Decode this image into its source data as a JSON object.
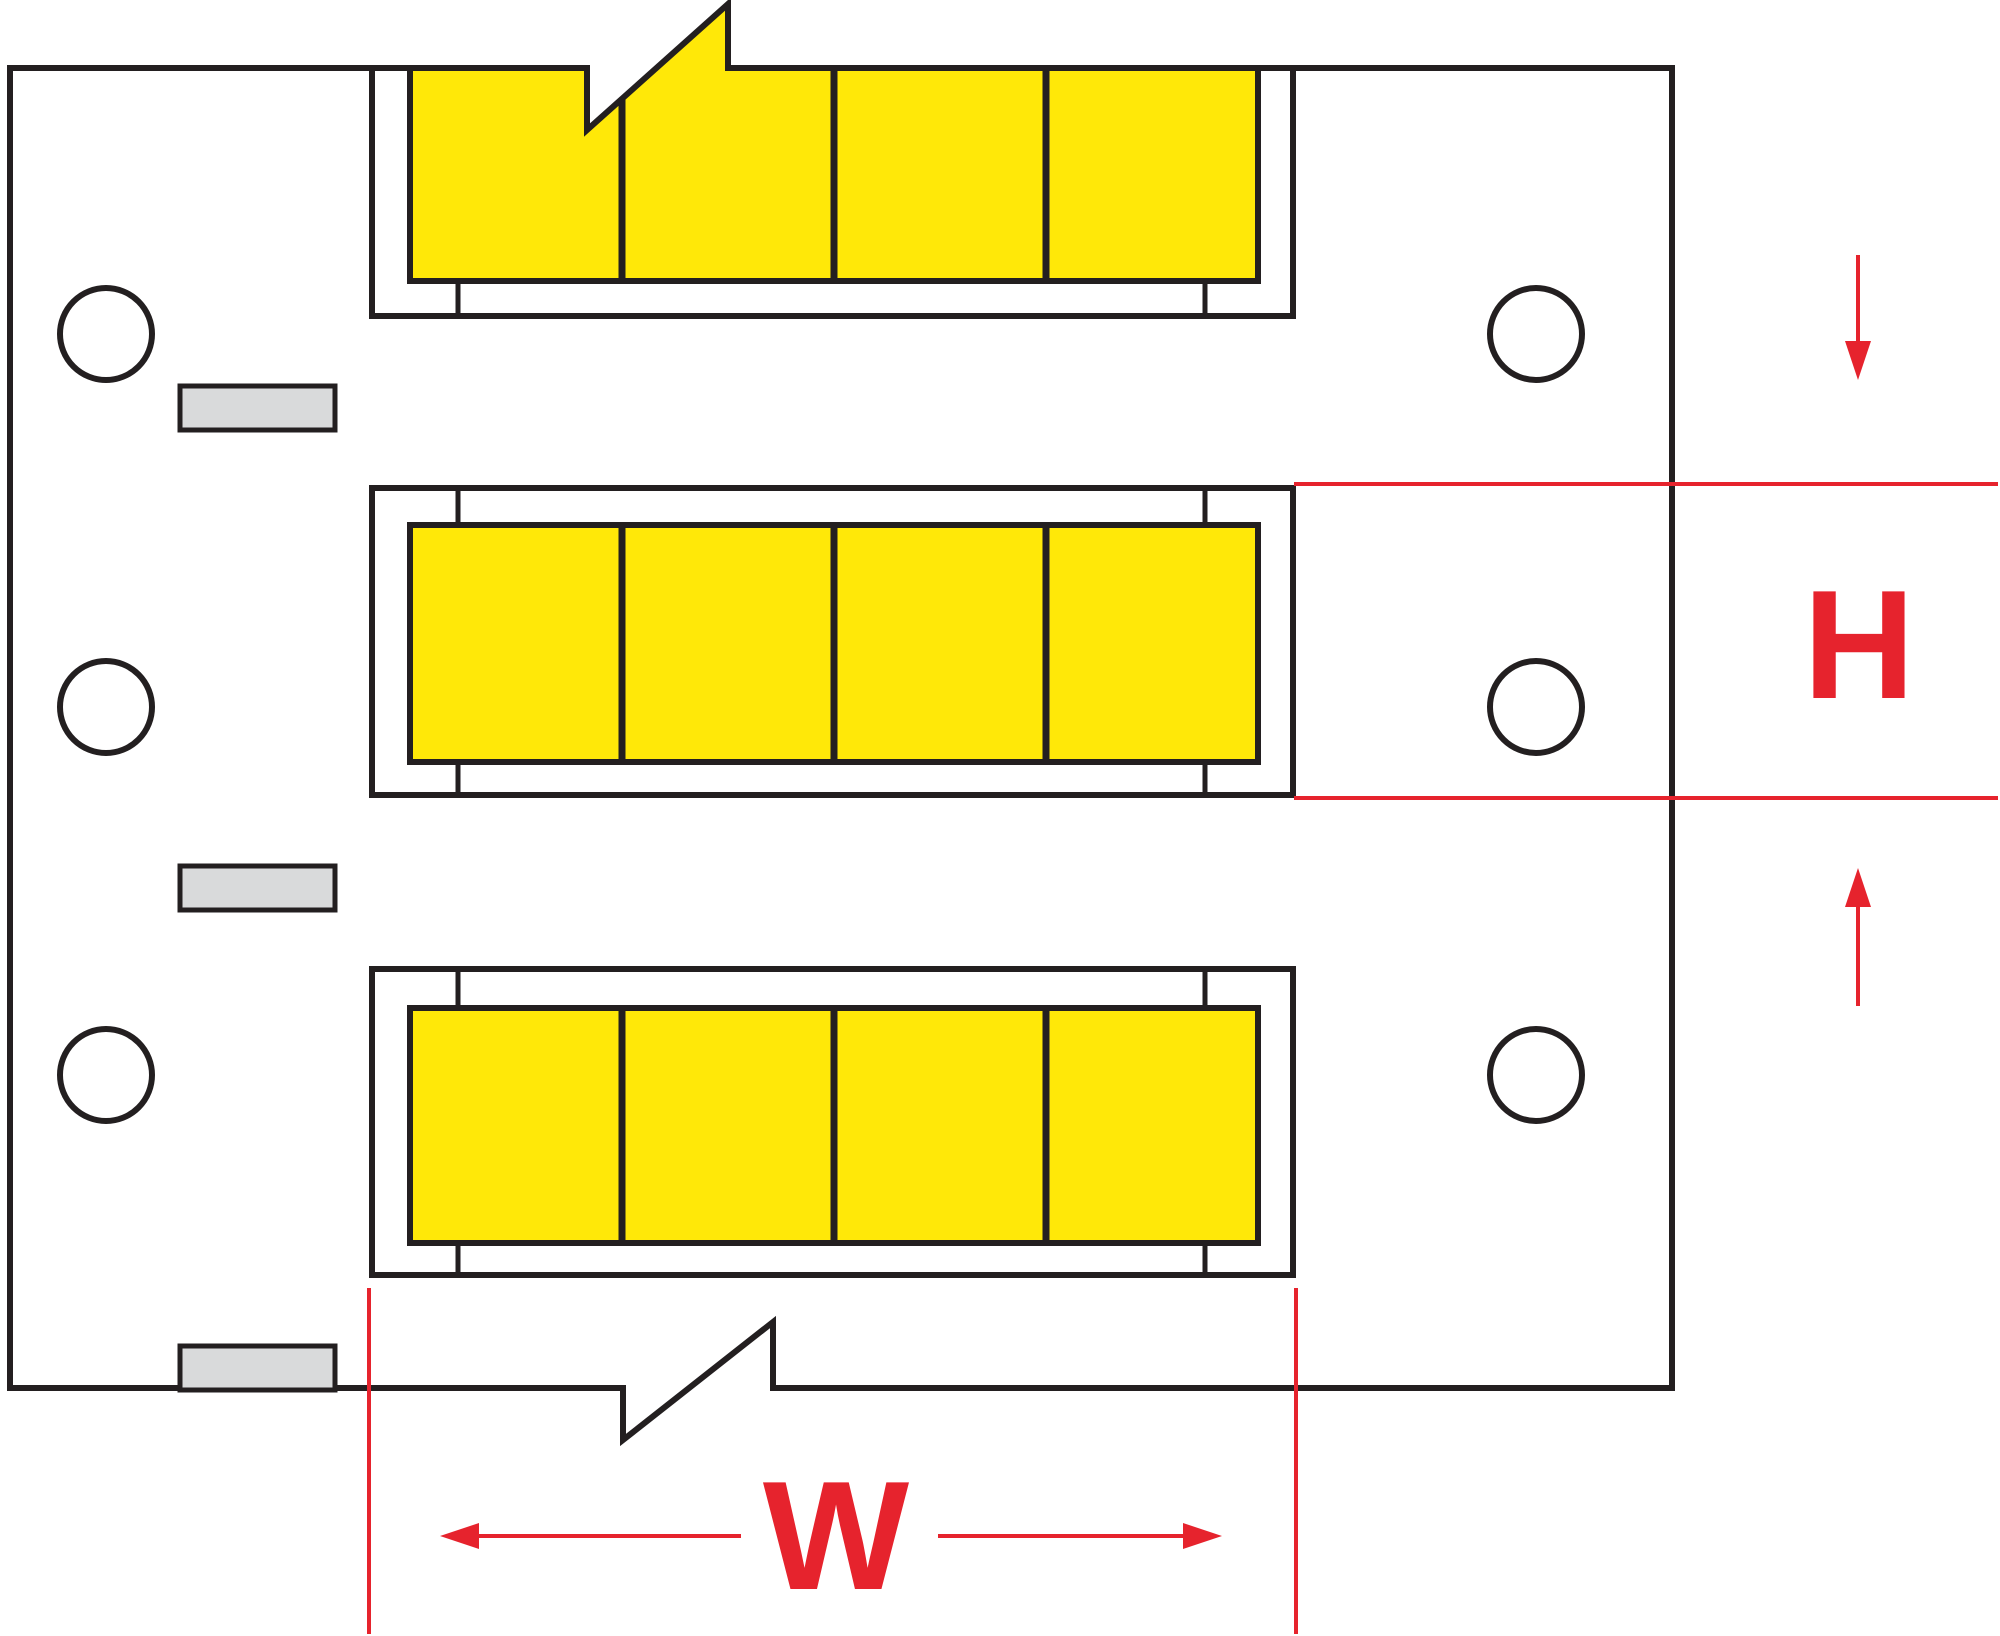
{
  "diagram": {
    "kind": "heat-shrink sleeve label carrier strip dimension diagram",
    "dimension_labels": {
      "height": "H",
      "width": "W"
    },
    "structure": {
      "sleeve_rows": 3,
      "sleeves_per_row": 4,
      "feed_holes_per_side": 3,
      "liner_tabs": 3
    },
    "colors": {
      "sleeve": "#FFE808",
      "dimension": "#E6232D",
      "outline": "#231F20",
      "tab": "#D9DADB",
      "background": "#FFFFFF"
    }
  }
}
